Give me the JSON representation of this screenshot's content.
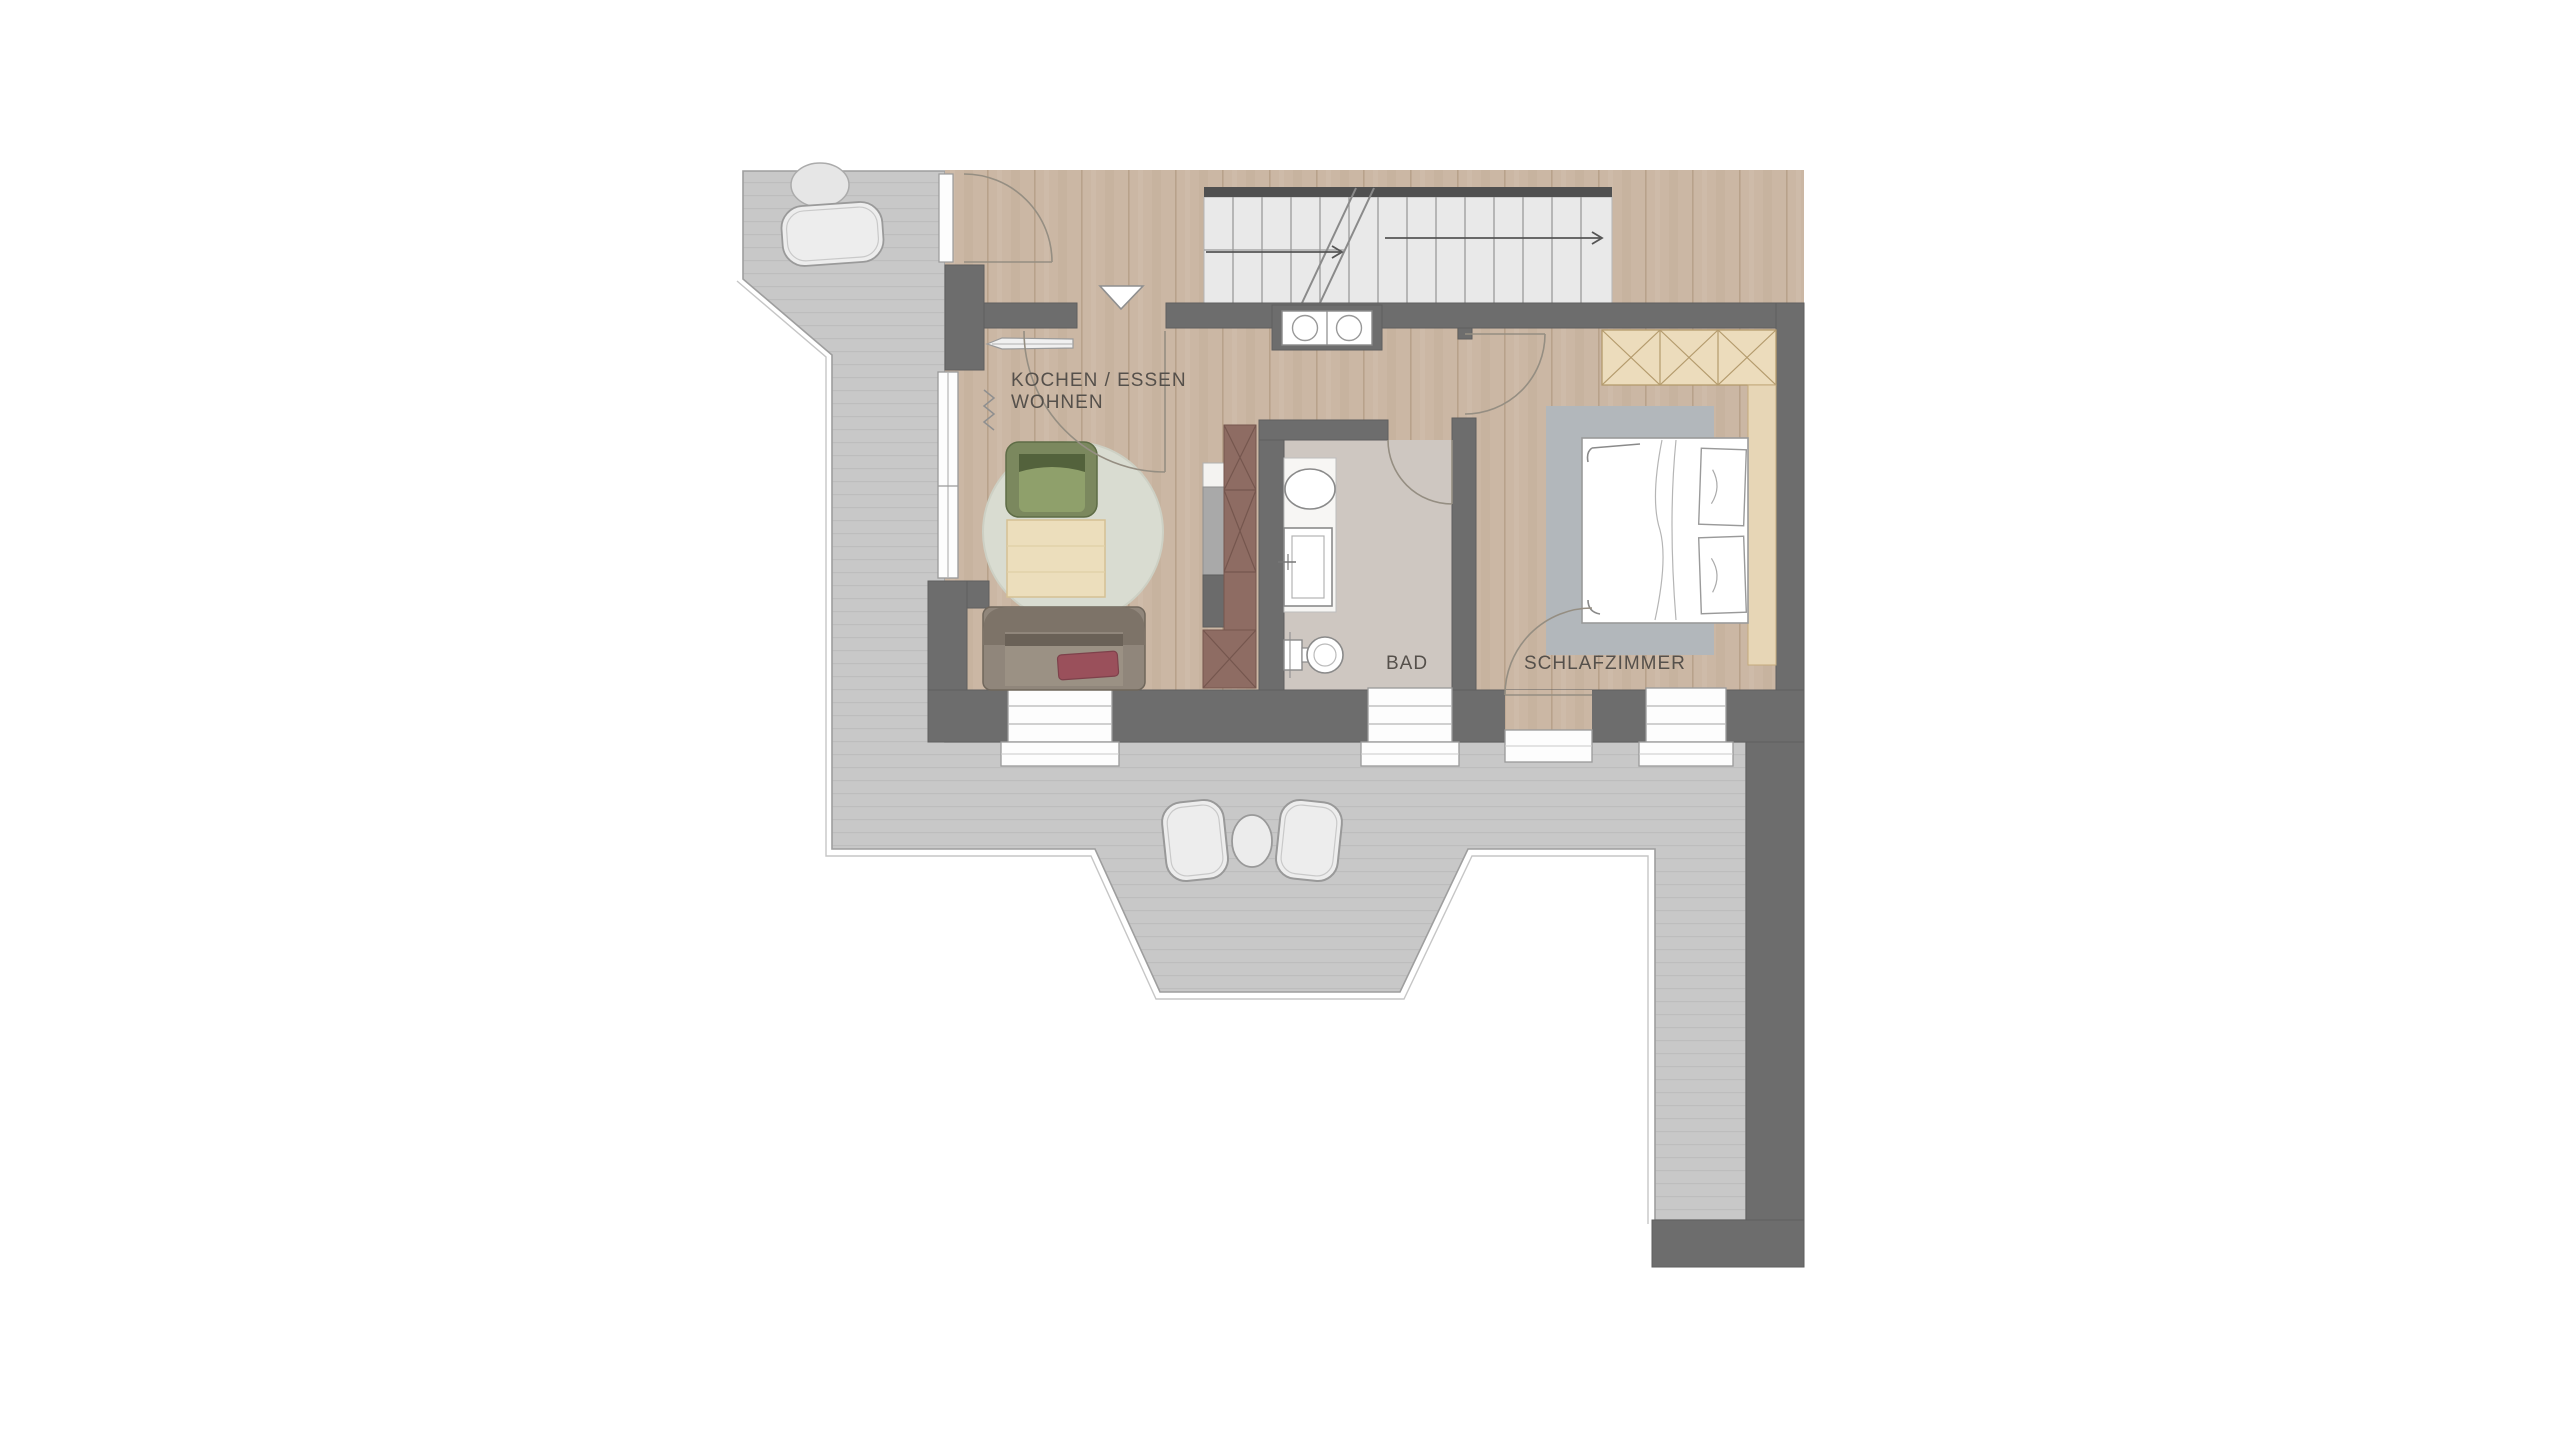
{
  "plan": {
    "type": "apartment-floor-plan",
    "rooms": {
      "kitchen_living": {
        "line1": "KOCHEN / ESSEN",
        "line2": "WOHNEN"
      },
      "bathroom": {
        "label": "BAD"
      },
      "bedroom": {
        "label": "SCHLAFZIMMER"
      }
    },
    "colors": {
      "background": "#ffffff",
      "wall": "#6d6d6d",
      "wood_floor": "#cbb7a4",
      "bath_floor": "#cec7c1",
      "terrace": "#c8c8c8",
      "stair_tread": "#e9e9e9",
      "cabinet_red": "#8e6c63",
      "wardrobe_tan": "#ecdcbc",
      "armchair_green": "#7b885e",
      "sofa_taupe": "#90867b",
      "pillow_red": "#9a505b",
      "rug_living": "#d9dcd1",
      "rug_bedroom": "#b2b7bb",
      "label_text": "#55504b"
    },
    "furniture_icons": [
      "stairs",
      "direction-arrow",
      "entry-triangle",
      "cooktop",
      "kitchen-tall-cabinet",
      "coat-rack",
      "radiator",
      "armchair",
      "coffee-table",
      "round-rug",
      "sofa",
      "sofa-pillow",
      "washbasin",
      "shower",
      "toilet",
      "bed",
      "bed-pillow",
      "bedroom-rug",
      "wardrobe",
      "terrace-chair",
      "terrace-table",
      "stone",
      "window",
      "door-swing"
    ]
  }
}
